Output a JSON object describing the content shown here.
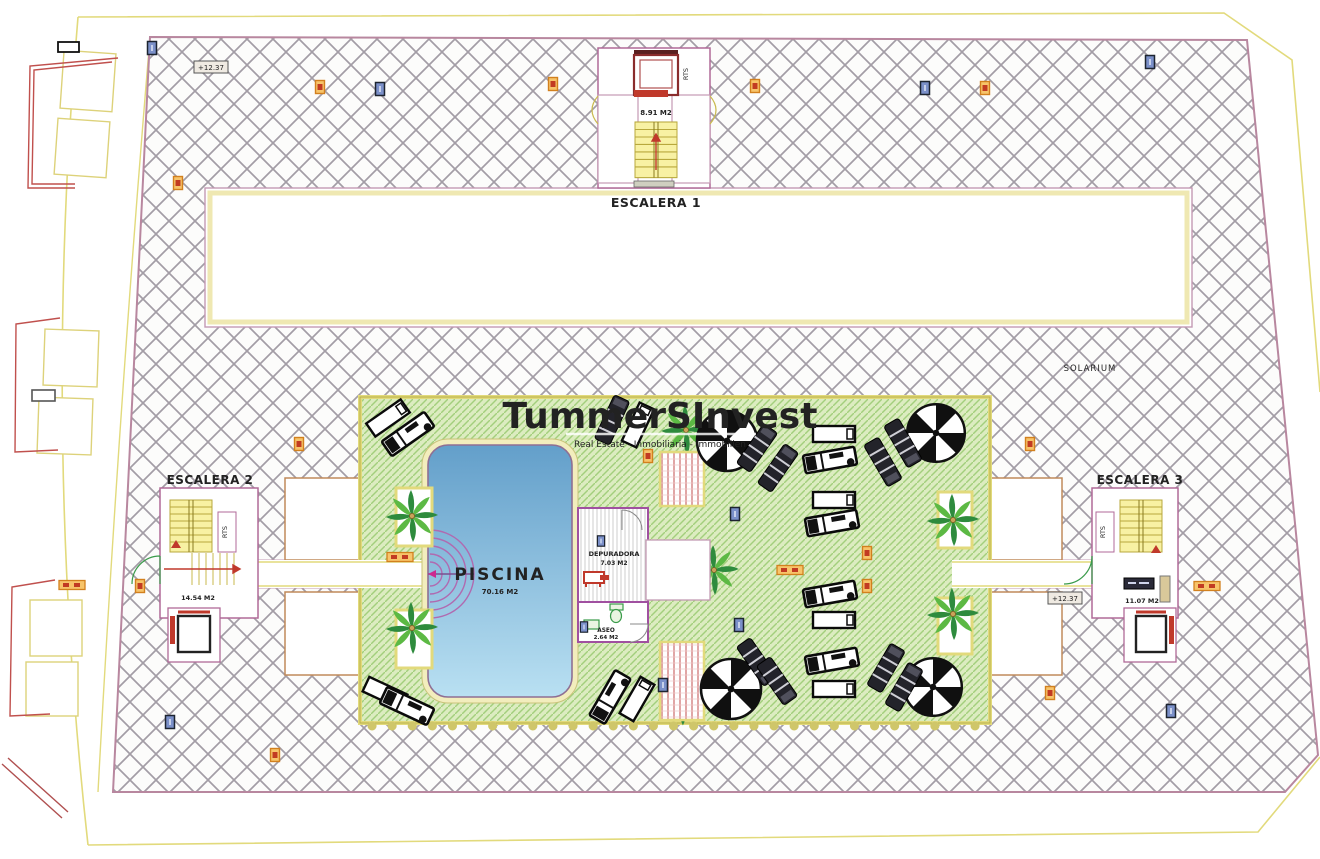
{
  "drawing": {
    "title_context": "Rooftop solarium floor plan",
    "escalera1": {
      "label": "ESCALERA 1",
      "area": "8.91 M2",
      "rts": "RTS"
    },
    "escalera2": {
      "label": "ESCALERA 2",
      "area": "14.54 M2",
      "rts": "RTS"
    },
    "escalera3": {
      "label": "ESCALERA 3",
      "area": "11.07 M2",
      "rts": "RTS"
    },
    "solarium_label": "SOLARIUM",
    "pool": {
      "label": "PISCINA",
      "area": "70.16 M2"
    },
    "depuradora": {
      "label": "DEPURADORA",
      "area": "7.03 M2"
    },
    "aseo": {
      "label": "ASEO",
      "area": "2.64 M2"
    },
    "elevation_marker": "+12.37",
    "watermark": {
      "brand": "TummerSInvest",
      "tagline": "Real Estate - Inmobiliaria - Immobilien"
    }
  },
  "colors": {
    "pool_top": "#639fca",
    "pool_bottom": "#b9e0f2",
    "deck_green": "#dcecc0",
    "deck_stripe": "#a3cf7c",
    "hatch_line": "#a39da6",
    "boundary_yellow": "#e2da7c",
    "wall_pink": "#b06a98",
    "accent_red": "#c0392b",
    "stair_yellow": "#f8f1a3",
    "marker_orange": "#f7c46a",
    "marker_blue": "#7b90c9",
    "pool_text": "#223a6e"
  }
}
